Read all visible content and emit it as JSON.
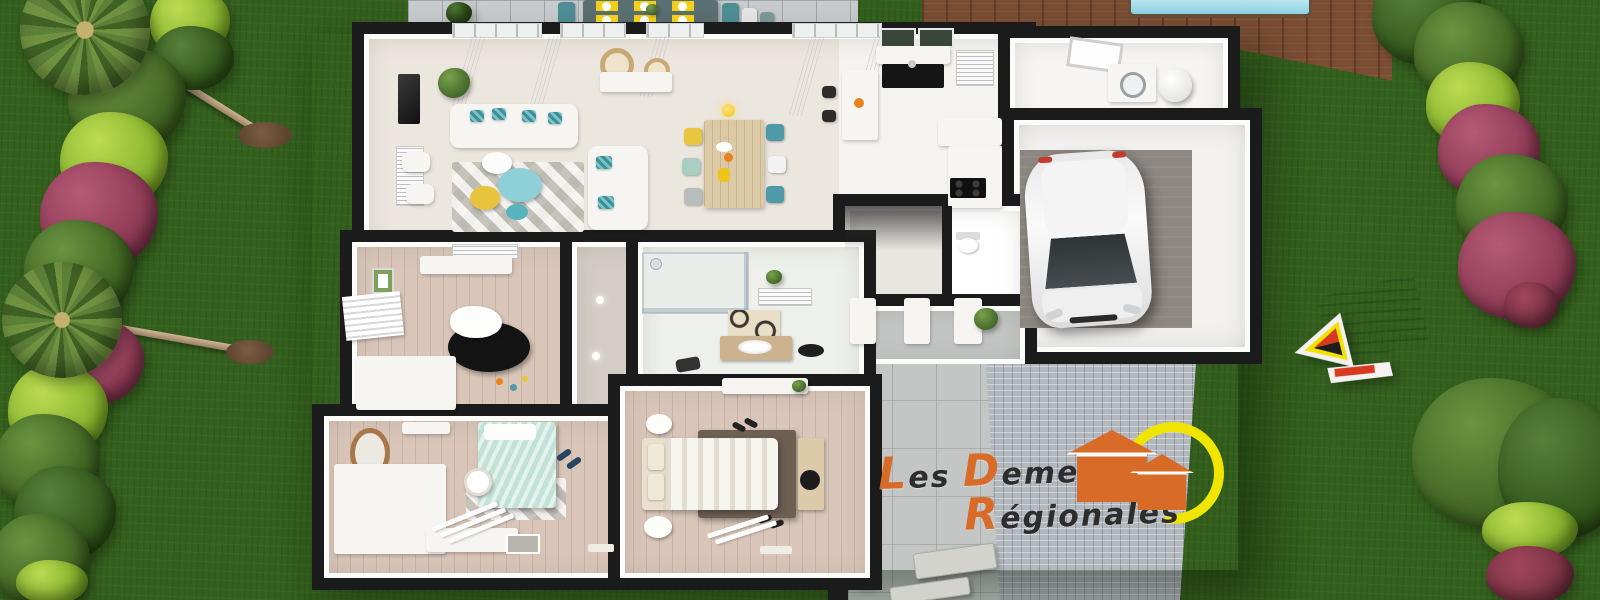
{
  "logo": {
    "full_name": "Les Demeures Régionales",
    "words": [
      {
        "initial": "L",
        "rest": "es"
      },
      {
        "initial": "D",
        "rest": "emeures"
      },
      {
        "initial": "R",
        "rest": "égionales"
      }
    ],
    "accent_color": "#d96b28",
    "sun_color": "#f0e500",
    "text_color": "#2d2d2d"
  },
  "palette": {
    "grass": "#35611e",
    "wall_black": "#1b1b1b",
    "interior_floor": "#ebe6de",
    "bedroom_floor": "#d9c6b9",
    "garage_floor": "#8d8781",
    "paver_grey": "#c9cdcf",
    "cobblestone_grey": "#b6bac1",
    "deck_wood": "#7b4e33",
    "pool_water": "#8fd2e4",
    "facade_pale_yellow": "#ece6c4",
    "accent_teal": "#4e9aa8",
    "accent_yellow": "#e8c63e",
    "accent_orange": "#e8821d",
    "bedding_mint": "#c3e2d7",
    "rug_brown": "#6e5f53",
    "bush_green": "#3c6020",
    "bush_lime": "#86b32c",
    "bush_magenta": "#8e3a55"
  }
}
